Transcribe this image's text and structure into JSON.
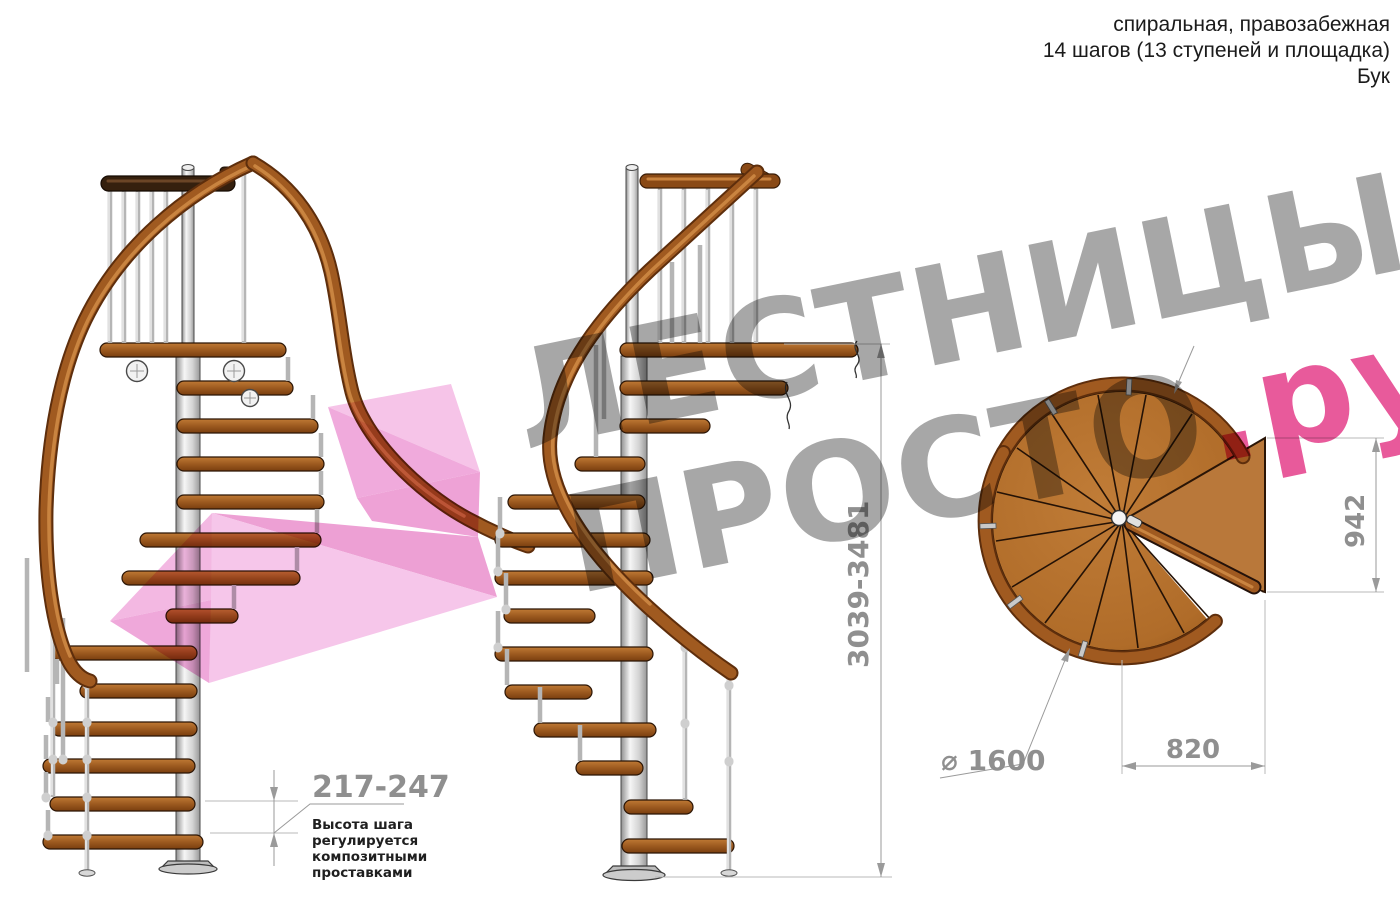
{
  "header": {
    "line1": "спиральная, правозабежная",
    "line2": "14 шагов (13 ступеней и площадка)",
    "line3": "Бук"
  },
  "watermark": {
    "brand_top": "ЛЕСТНИЦЫ",
    "brand_bottom": "ПРОСТО",
    "brand_domain": ".ру"
  },
  "dimensions": {
    "step_height": "217-247",
    "step_height_note": [
      "Высота шага",
      "регулируется",
      "композитными",
      "проставками"
    ],
    "total_height": "3039-3481",
    "plan_depth": "942",
    "diameter": "⌀ 1600",
    "plan_width": "820"
  },
  "colors": {
    "wood": "#a05a20",
    "wood_dark": "#7c3f10",
    "rail": "#8a4a16",
    "metal_pole": "#d9d9d9",
    "dimension_gray": "#9a9a9a",
    "note_text": "#1f1f1f",
    "watermark_gray": "#a7a7a7",
    "watermark_pink": "#e85a9b",
    "arrow_pink": "#f3b3e0"
  }
}
